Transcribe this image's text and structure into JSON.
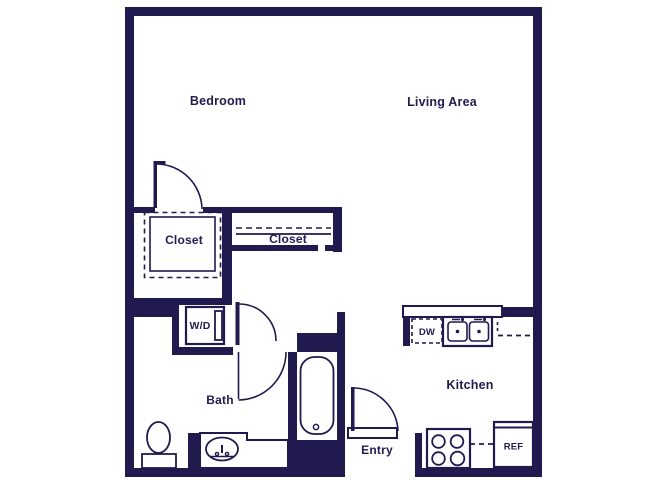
{
  "floor_plan": {
    "colors": {
      "wall": "#211a4e",
      "text": "#221b4f",
      "background": "#ffffff"
    },
    "rooms": {
      "bedroom": {
        "label": "Bedroom"
      },
      "living_area": {
        "label": "Living Area"
      },
      "walk_in_closet": {
        "label": "Closet"
      },
      "hall_closet": {
        "label": "Closet"
      },
      "bath": {
        "label": "Bath"
      },
      "kitchen": {
        "label": "Kitchen"
      },
      "entry": {
        "label": "Entry"
      }
    },
    "fixtures": {
      "washer_dryer": {
        "label": "W/D"
      },
      "dishwasher": {
        "label": "DW"
      },
      "refrigerator": {
        "label": "REF"
      }
    }
  }
}
